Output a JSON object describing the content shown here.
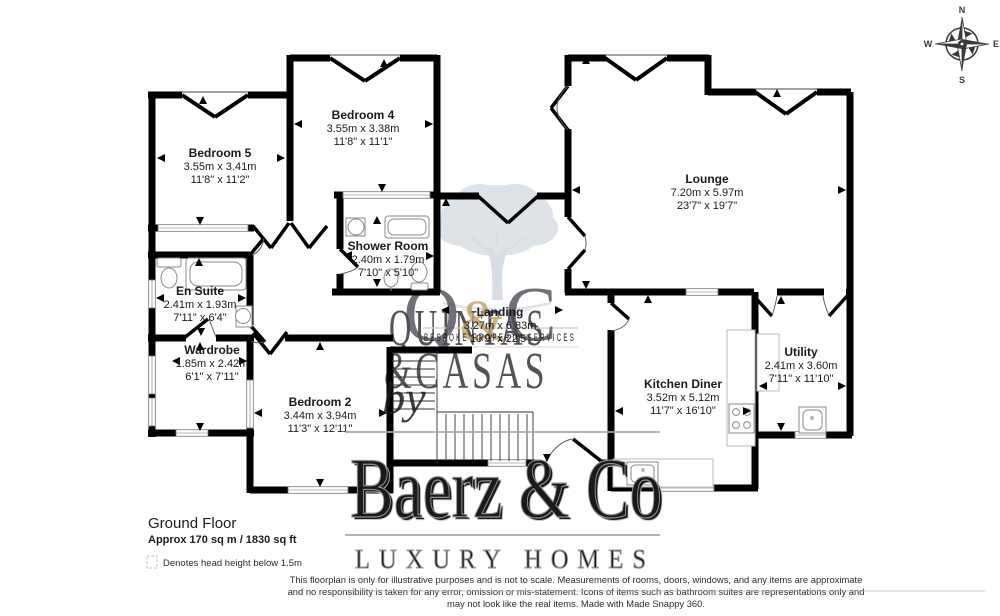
{
  "floor": {
    "name": "Ground Floor",
    "area": "Approx 170 sq m / 1830 sq ft"
  },
  "legend": {
    "head_height": "Denotes head height below 1.5m"
  },
  "disclaimer": {
    "line1": "This floorplan is only for illustrative purposes and is not to scale. Measurements of rooms, doors, windows, and any items are approximate",
    "line2": "and no responsibility is taken for any error, omission or mis-statement. Icons of items such as bathroom suites are representations only and",
    "line3": "may not look like the real items. Made with Made Snappy 360."
  },
  "compass": {
    "n": "N",
    "e": "E",
    "s": "S",
    "w": "W"
  },
  "watermark": {
    "monogram": {
      "q": "Q",
      "amp": "&",
      "c": "C"
    },
    "brand_line1": "QUINTAS",
    "brand_line2": "&CASAS",
    "tagline": "BESPOKE PROPERTY SERVICES",
    "by": "by",
    "agency": "Baerz & Co",
    "agency_tagline": "LUXURY HOMES"
  },
  "rooms": [
    {
      "name": "Bedroom 5",
      "metric": "3.55m x 3.41m",
      "imperial": "11'8\" x 11'2\""
    },
    {
      "name": "Bedroom 4",
      "metric": "3.55m x 3.38m",
      "imperial": "11'8\" x 11'1\""
    },
    {
      "name": "Shower Room",
      "metric": "2.40m x 1.79m",
      "imperial": "7'10\" x 5'10\""
    },
    {
      "name": "En Suite",
      "metric": "2.41m x 1.93m",
      "imperial": "7'11\" x 6'4\""
    },
    {
      "name": "Wardrobe",
      "metric": "1.85m x 2.42m",
      "imperial": "6'1\" x 7'11\""
    },
    {
      "name": "Bedroom 2",
      "metric": "3.44m x 3.94m",
      "imperial": "11'3\" x 12'11\""
    },
    {
      "name": "Landing",
      "metric": "3.27m x 6.83m",
      "imperial": "10'9\" x 22'5\""
    },
    {
      "name": "Lounge",
      "metric": "7.20m x 5.97m",
      "imperial": "23'7\" x 19'7\""
    },
    {
      "name": "Kitchen Diner",
      "metric": "3.52m x 5.12m",
      "imperial": "11'7\" x 16'10\""
    },
    {
      "name": "Utility",
      "metric": "2.41m x 3.60m",
      "imperial": "7'11\" x 11'10\""
    }
  ],
  "colors": {
    "wall": "#000000",
    "accent_tan": "#c1a066",
    "brand_tan": "#dbceb8",
    "watermark_gray": "#9a9a9a",
    "tree": "#c3cdd5"
  }
}
